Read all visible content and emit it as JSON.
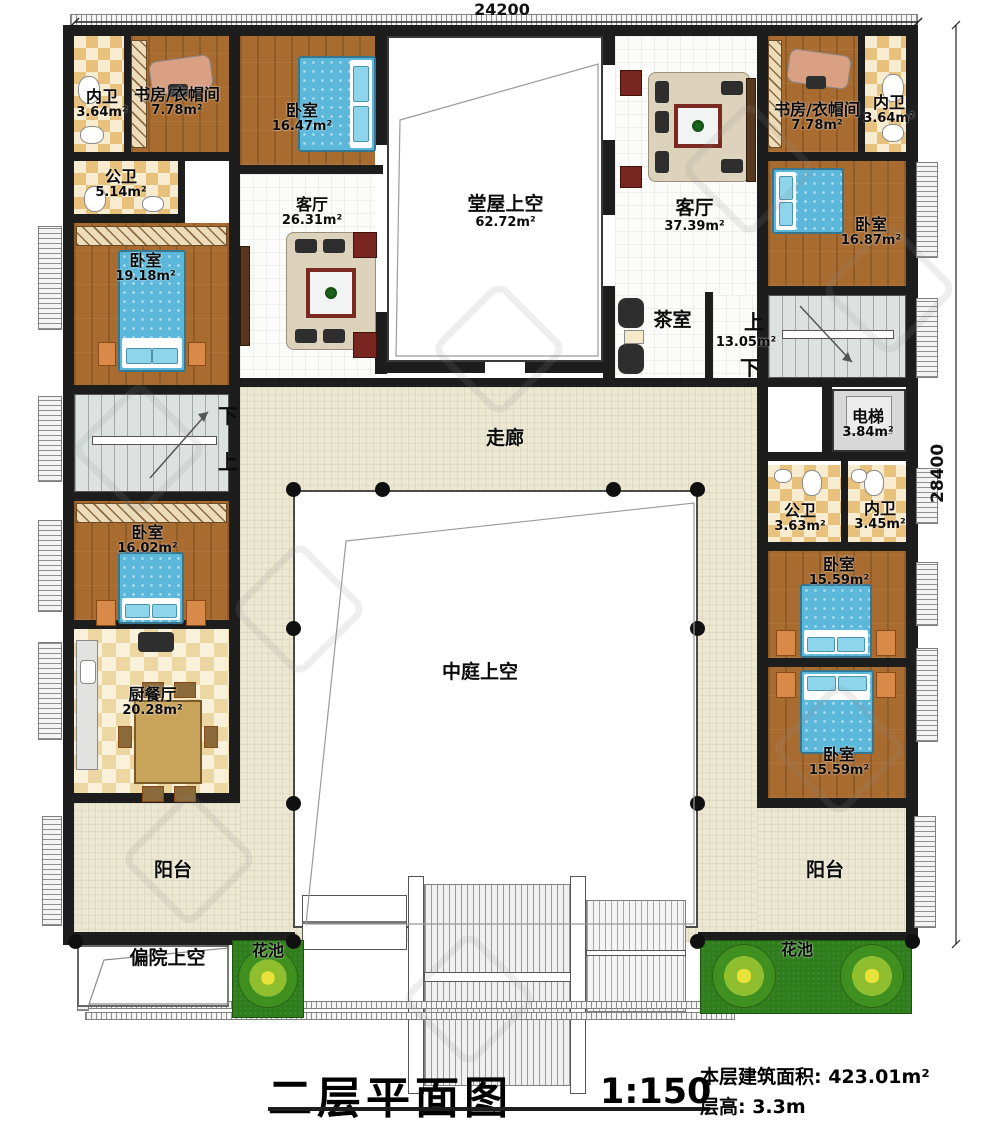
{
  "dimensions": {
    "width_label": "24200",
    "height_label": "28400"
  },
  "title": {
    "main": "二层平面图",
    "scale": "1:150",
    "build_area": "本层建筑面积: 423.01m²",
    "floor_height": "层高: 3.3m"
  },
  "rooms": {
    "neiwei_tl": {
      "name": "内卫",
      "area": "3.64m²"
    },
    "shufang_tl": {
      "name": "书房/衣帽间",
      "area": "7.78m²"
    },
    "woshi_1647": {
      "name": "卧室",
      "area": "16.47m²"
    },
    "gongwei_tl": {
      "name": "公卫",
      "area": "5.14m²"
    },
    "woshi_1918": {
      "name": "卧室",
      "area": "19.18m²"
    },
    "keting_l": {
      "name": "客厅",
      "area": "26.31m²"
    },
    "tangwu": {
      "name": "堂屋上空",
      "area": "62.72m²"
    },
    "keting_r": {
      "name": "客厅",
      "area": "37.39m²"
    },
    "shufang_tr": {
      "name": "书房/衣帽间",
      "area": "7.78m²"
    },
    "neiwei_tr": {
      "name": "内卫",
      "area": "3.64m²"
    },
    "woshi_1687": {
      "name": "卧室",
      "area": "16.87m²"
    },
    "chashi": {
      "name": "茶室",
      "area": "13.05m²"
    },
    "dianti": {
      "name": "电梯",
      "area": "3.84m²"
    },
    "zoulang": {
      "name": "走廊"
    },
    "gongwei_r": {
      "name": "公卫",
      "area": "3.63m²"
    },
    "neiwei_r": {
      "name": "内卫",
      "area": "3.45m²"
    },
    "woshi_1602": {
      "name": "卧室",
      "area": "16.02m²"
    },
    "woshi_1559a": {
      "name": "卧室",
      "area": "15.59m²"
    },
    "zhongting": {
      "name": "中庭上空"
    },
    "chucanting": {
      "name": "厨餐厅",
      "area": "20.28m²"
    },
    "woshi_1559b": {
      "name": "卧室",
      "area": "15.59m²"
    },
    "yangtai_l": {
      "name": "阳台"
    },
    "yangtai_r": {
      "name": "阳台"
    },
    "pianyuan": {
      "name": "偏院上空"
    },
    "huachi_l": {
      "name": "花池"
    },
    "huachi_r": {
      "name": "花池"
    }
  },
  "stairs": {
    "left_down": "下",
    "left_up": "上",
    "right_up": "上",
    "right_down": "下"
  }
}
